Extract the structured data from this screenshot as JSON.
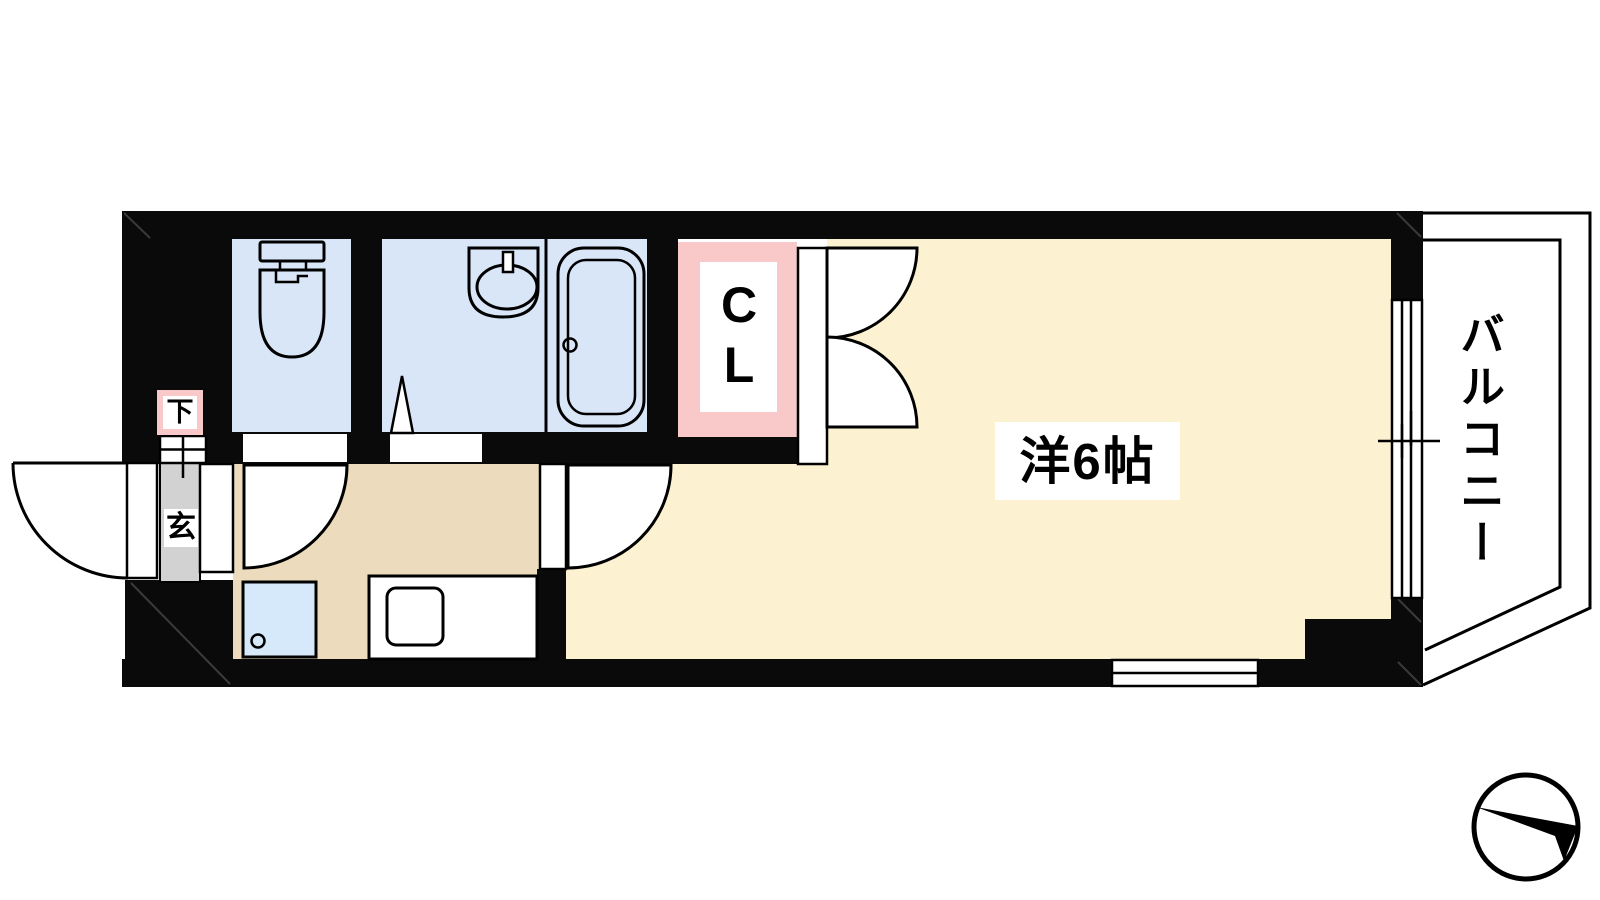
{
  "floor_plan": {
    "rooms": {
      "main_room": {
        "label": "洋6帖"
      },
      "balcony": {
        "label": "バルコニー"
      },
      "closet": {
        "label": "CL"
      },
      "entrance": {
        "label": "玄"
      },
      "shoe_cabinet": {
        "label": "下"
      }
    },
    "colors": {
      "wall": "#0a0a0a",
      "wet_room_floor": "#d9e6f7",
      "main_room_floor": "#fcf1d0",
      "kitchen_floor": "#ecdcbd",
      "entrance_floor": "#d3d2d3",
      "closet_fill": "#f9c8c8",
      "washer_fill": "#d6e9fa",
      "label_bg": "#ffffff",
      "line": "#000000"
    },
    "icons": {
      "toilet": "toilet-icon",
      "bathtub": "bathtub-icon",
      "bathroom_sink": "bathroom-sink-icon",
      "kitchen_sink": "kitchen-sink-icon",
      "washing_machine": "washing-machine-icon",
      "north_arrow": "north-arrow-icon"
    }
  }
}
